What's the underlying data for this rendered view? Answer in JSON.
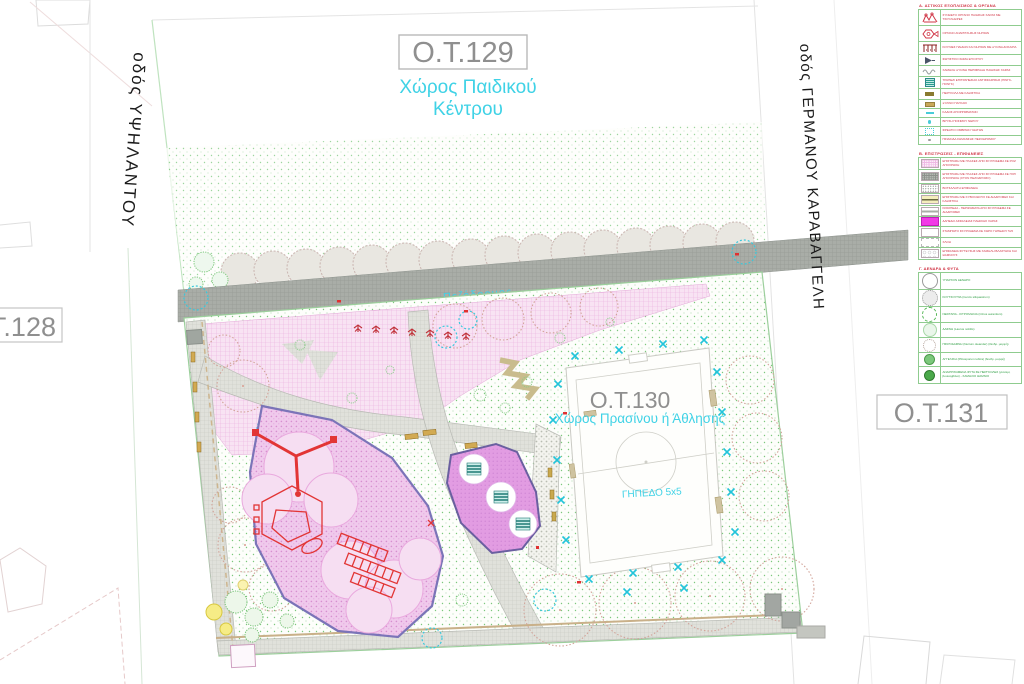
{
  "map": {
    "ot129": {
      "label": "Ο.Τ.129",
      "subtitle1": "Χώρος Παιδικού",
      "subtitle2": "Κέντρου"
    },
    "ot128": {
      "label": "Ο.Τ.128"
    },
    "ot130": {
      "label": "Ο.Τ.130",
      "subtitle": "Χώρος Πρασίνου ή Άθλησης",
      "field": "ΓΗΠΕΔΟ 5x5"
    },
    "ot131": {
      "label": "Ο.Τ.131"
    },
    "streets": {
      "left": "οδός ΥΨΗΛΑΝΤΟΥ",
      "right": "οδός ΓΕΡΜΑΝΟΥ ΚΑΡΑΒΑΓΓΕΛΗ",
      "pedestrian": "Πεζόδρομος"
    }
  },
  "legend": {
    "sections": [
      {
        "header": "Α. ΑΣΤΙΚΟΣ ΕΞΟΠΛΙΣΜΟΣ & ΟΡΓΑΝΑ",
        "rows": [
          {
            "label": "ΣΥΝΘΕΤΟ ΟΡΓΑΝΟ ΠΑΙΔΙΚΗΣ ΧΑΡΑΣ ΜΕ ΤΣΟΥΛΗΘΡΕΣ"
          },
          {
            "label": "ΟΡΓΑΝΟ ΑΝΑΡΡΙΧΗΣΗΣ ΝΗΠΙΩΝ"
          },
          {
            "label": "ΚΟΥΝΙΕΣ ΠΑΙΔΩΝ ΚΑΙ ΝΗΠΙΩΝ ΜΕ ΞΥΛΙΝΑ ΔΟΚΑΡΙΑ"
          },
          {
            "label": "ΦΩΤΙΣΤΙΚΟ ΣΩΜΑ ΕΠΙ ΙΣΤΟΥ"
          },
          {
            "label": "ΧΑΜΗΛΗ ΞΥΛΙΝΗ ΠΕΡΙΦΡΑΞΗ ΠΑΙΔΙΚΗΣ ΧΑΡΑΣ"
          },
          {
            "label": "ΤΡΑΠΕΖΙ ΕΠΙΤΡΑΠΕΖΙΑΣ ΑΝΤΙΣΦΑΙΡΙΣΗΣ (ΠΙΝΓΚ-ΠΟΝΓΚ)"
          },
          {
            "label": "ΠΕΡΓΚΟΛΑ ΜΕ ΚΑΘΙΣΤΙΚΑ"
          },
          {
            "label": "ΞΥΛΙΝΟ ΠΑΓΚΑΚΙ"
          },
          {
            "label": "ΚΑΔΟΣ ΑΠΟΡΡΙΜΜΑΤΩΝ"
          },
          {
            "label": "ΒΡΥΣΗ ΠΟΣΙΜΟΥ ΝΕΡΟΥ"
          },
          {
            "label": "ΦΡΕΑΤΙΟ ΟΜΒΡΙΩΝ ΥΔΑΤΩΝ"
          },
          {
            "label": "ΠΙΝΑΚΙΔΑ ΣΗΜΑΝΣΗΣ ΠΕΖΟΔΡΟΜΟΥ"
          }
        ]
      },
      {
        "header": "Β. ΕΠΙΣΤΡΩΣΕΙΣ - ΕΠΙΦΑΝΕΙΕΣ",
        "rows": [
          {
            "label": "ΕΠΙΣΤΡΩΣΗ ΜΕ ΠΛΑΚΕΣ ΑΠΟ ΣΚΥΡΟΔΕΜΑ ΣΕ ΡΟΖ ΑΠΟΧΡΩΣΗ"
          },
          {
            "label": "ΕΠΙΣΤΡΩΣΗ ΜΕ ΠΛΑΚΕΣ ΑΠΟ ΣΚΥΡΟΔΕΜΑ ΣΕ ΓΚΡΙ ΑΠΟΧΡΩΣΗ (ΣΤΟΝ ΠΕΖΟΔΡΟΜΟ)"
          },
          {
            "label": "ΒΟΤΣΑΛΩΤΗ ΕΠΙΦΑΝΕΙΑ"
          },
          {
            "label": "ΕΠΙΣΤΡΩΣΗ ΜΕ ΚΥΒΟΛΙΘΟΥΣ ΣΕ ΔΙΑΔΡΟΜΕΣ ΚΑΙ ΚΑΘΙΣΤΙΚΑ"
          },
          {
            "label": "ΚΡΑΣΠΕΔΑ - ΠΕΡΙΖΩΜΑΤΑ ΑΠΟ ΣΚΥΡΟΔΕΜΑ ΣΕ ΔΙΑΔΡΟΜΕΣ"
          },
          {
            "label": "ΔΑΠΕΔΟ ΑΣΦΑΛΕΙΑΣ ΠΑΙΔΙΚΗΣ ΧΑΡΑΣ"
          },
          {
            "label": "ΣΤΑΜΠΩΤΟ ΣΚΥΡΟΔΕΜΑ ΣΕ ΧΩΡΟ ΓΗΠΕΔΟΥ 5x5"
          },
          {
            "label": "ΧΛΟΗ"
          },
          {
            "label": "ΕΠΙΦΑΝΕΙΑ ΦΥΤΕΥΣΗΣ ΜΕ ΧΑΜΗΛΗ ΒΛΑΣΤΗΣΗ ΚΑΙ ΘΑΜΝΟΥΣ"
          }
        ]
      },
      {
        "header": "Γ. ΔΕΝΔΡΑ & ΦΥΤΑ",
        "rows": [
          {
            "label": "ΥΠΑΡΧΟΝ ΔΕΝΔΡΟ"
          },
          {
            "label": "ΚΟΥΤΣΟΥΠΙΑ (Cercis siliquastrum)"
          },
          {
            "label": "ΝΕΡΑΤΖΙΑ - ΚΙΤΡΟΜΗΛΙΑ (Citrus aurantium)"
          },
          {
            "label": "ΔΑΦΝΗ (Laurus nobilis)"
          },
          {
            "label": "ΠΙΚΡΟΔΑΦΝΗ (Nerium oleander) (δενδρ. μορφή)"
          },
          {
            "label": "ΑΓΓΕΛΙΚΗ (Pittosporum tobira) (δενδρ. μορφή)"
          },
          {
            "label": "ΑΝΑΡΡΙΧΩΜΕΝΑ ΦΥΤΑ ΣΕ ΠΕΡΓΚΟΛΕΣ (γιασεμί, βουκαμβίλια) - ΧΑΜΗΛΟΙ ΘΑΜΝΟΙ"
          }
        ]
      }
    ]
  },
  "colors": {
    "accent_cyan": "#3fd2e6",
    "block_label_grey": "#8f8f8f",
    "legend_red": "#d03545",
    "legend_green": "#2f9e44",
    "legend_border_green": "#8fcc8f",
    "playground_pink": "#f0c9ec",
    "safety_floor_magenta": "#f23ae6",
    "walkway_grey": "#a9ada7"
  }
}
